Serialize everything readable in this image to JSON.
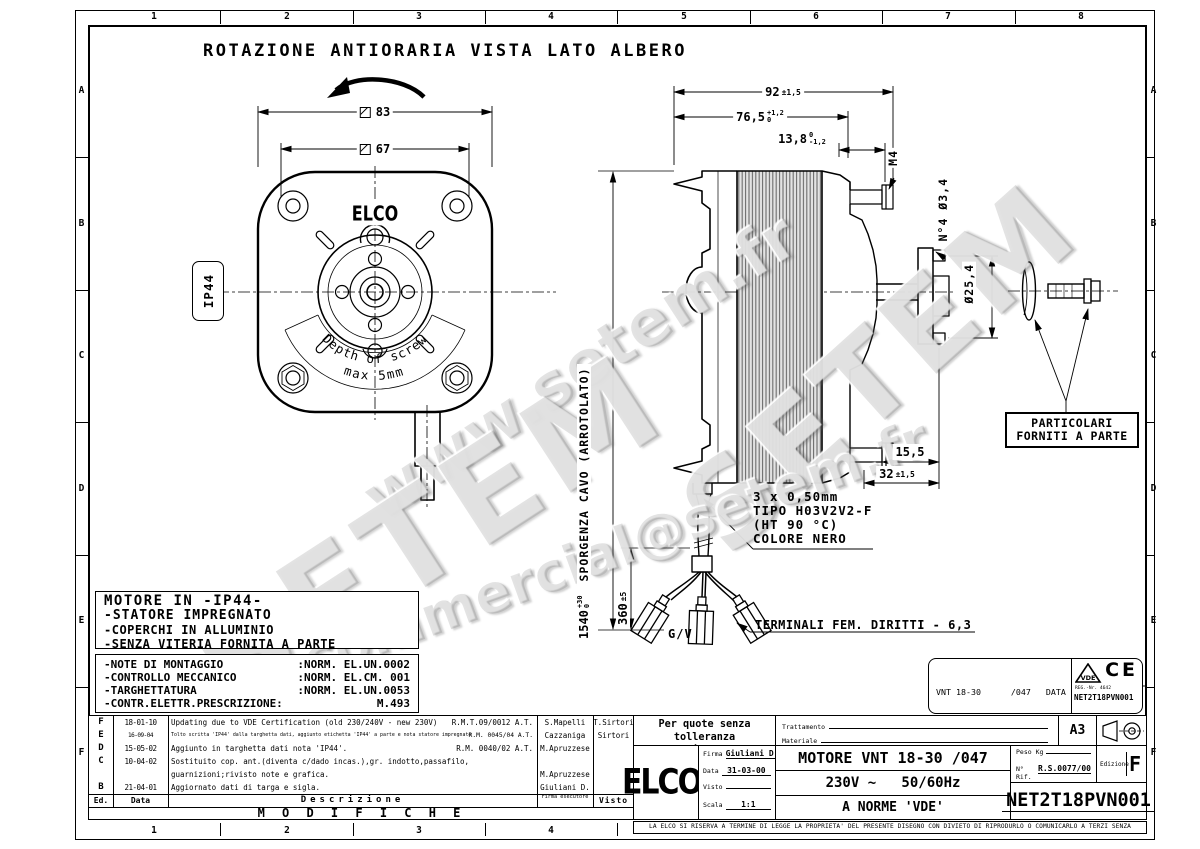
{
  "sheet": {
    "title": "ROTAZIONE ANTIORARIA VISTA LATO ALBERO",
    "columns": [
      "1",
      "2",
      "3",
      "4",
      "5",
      "6",
      "7",
      "8"
    ],
    "columns_bottom": [
      "1",
      "2",
      "3",
      "4"
    ],
    "rows": [
      "A",
      "B",
      "C",
      "D",
      "E",
      "F"
    ],
    "disclaimer": "LA ELCO SI RISERVA A TERMINE DI LEGGE LA PROPRIETA' DEL PRESENTE DISEGNO CON DIVIETO DI RIPRODURLO O COMUNICARLO A TERZI SENZA AUTORIZZAZIONE"
  },
  "watermarks": {
    "url": "www.setem.fr",
    "brand": "SETEM",
    "brand2": "SETEM",
    "email": "commercial@setem.fr"
  },
  "front_view": {
    "dim_outer": "83",
    "dim_inner": "67",
    "ip_rating": "IP44",
    "logo": "ELCO",
    "depth_note_line1": "Depth of screw",
    "depth_note_line2": "max 5mm"
  },
  "side_view": {
    "dim_width": {
      "value": "92",
      "tol": "±1,5"
    },
    "dim_body": {
      "value": "76,5",
      "tol_up": "+1,2",
      "tol_dn": "0"
    },
    "dim_hub": {
      "value": "13,8",
      "tol_up": "0",
      "tol_dn": "-1,2"
    },
    "thread": "M4",
    "holes": "N°4 Ø3,4",
    "flange_dia": "Ø25,4",
    "dim_flange": "15,5",
    "dim_shaft": {
      "value": "32",
      "tol": "±1,5"
    }
  },
  "cable": {
    "length": {
      "value": "1540",
      "tol_up": "+30",
      "tol_dn": "0"
    },
    "length_note": "SPORGENZA CAVO (ARROTOLATO)",
    "free_length": {
      "value": "360",
      "tol": "±5"
    },
    "spec_line1": "3 x 0,50mm",
    "spec_line2": "TIPO H03V2V2-F",
    "spec_line3": "(HT 90 °C)",
    "spec_line4": "COLORE NERO",
    "ground_label": "G/V",
    "terminal_note": "TERMINALI FEM. DIRITTI - 6,3"
  },
  "parts_note": {
    "line1": "PARTICOLARI",
    "line2": "FORNITI A PARTE"
  },
  "motor_notes": {
    "title": "MOTORE IN -IP44-",
    "line1": "-STATORE IMPREGNATO",
    "line2": "-COPERCHI IN ALLUMINIO",
    "line3": "-SENZA VITERIA FORNITA A PARTE"
  },
  "norm_notes": {
    "rows": [
      {
        "label": "-NOTE DI MONTAGGIO",
        "value": ":NORM. EL.UN.0002"
      },
      {
        "label": "-CONTROLLO MECCANICO",
        "value": ":NORM. EL.CM. 001"
      },
      {
        "label": "-TARGHETTATURA",
        "value": ":NORM. EL.UN.0053"
      },
      {
        "label": "-CONTR.ELETTR.PRESCRIZIONE:",
        "value": "M.493"
      }
    ]
  },
  "revisions": {
    "rows": [
      {
        "ed": "F",
        "date": "18-01-10",
        "desc": "Updating due to VDE Certification (old 230/240V - new 230V)",
        "ref": "R.M.T.09/0012 A.T.",
        "firma": "S.Mapelli",
        "visto": "T.Sirtori"
      },
      {
        "ed": "E",
        "date": "16-09-04",
        "desc": "Tolto scritta 'IP44' dalla targhetta dati, aggiunto etichetta 'IP44' a parte e nota statore impregnato",
        "ref": "R.M. 0045/04 A.T.",
        "firma": "Cazzaniga",
        "visto": "Sirtori"
      },
      {
        "ed": "D",
        "date": "15-05-02",
        "desc": "Aggiunto in targhetta dati nota 'IP44'.",
        "ref": "R.M. 0040/02 A.T.",
        "firma": "M.Apruzzese",
        "visto": ""
      },
      {
        "ed": "C",
        "date": "10-04-02",
        "desc": "Sostituito cop. ant.(diventa c/dado incas.),gr. indotto,passafilo,",
        "ref": "",
        "firma": "",
        "visto": ""
      },
      {
        "ed": "",
        "date": "",
        "desc": "guarnizioni;rivisto note e grafica.",
        "ref": "",
        "firma": "M.Apruzzese",
        "visto": ""
      },
      {
        "ed": "B",
        "date": "21-04-01",
        "desc": "Aggiornato dati di targa e sigla.",
        "ref": "",
        "firma": "Giuliani D.",
        "visto": ""
      }
    ],
    "headers": {
      "ed": "Ed.",
      "date": "Data",
      "desc": "Descrizione",
      "firma": "Firma esecutore",
      "visto": "Visto"
    },
    "footer": "M O D I F I C H E"
  },
  "title_block": {
    "tolerance_note1": "Per quote senza tolleranza",
    "tolerance_note2": "normativa UNI EN 22768-mK",
    "trattamento_label": "Trattamento",
    "materiale_label": "Materiale",
    "format": "A3",
    "logo": "ELCO",
    "logo_reg": "®",
    "fields": {
      "firma_label": "Firma",
      "firma": "Giuliani D.",
      "data_label": "Data",
      "data": "31-03-00",
      "visto_label": "Visto",
      "visto": "",
      "scala_label": "Scala",
      "scala": "1:1"
    },
    "product_line1": "MOTORE VNT 18-30 /047",
    "product_line2": "230V ~   50/60Hz",
    "product_line3": "A NORME 'VDE'",
    "peso_label": "Peso Kg",
    "rif_label": "N° Rif.",
    "rif": "R.S.0077/00",
    "edizione_label": "Edizione",
    "edizione": "F",
    "code": "NET2T18PVN001"
  },
  "data_plate": {
    "line1": "VNT 18-30      /047   DATA",
    "line2": "230V ~50/60Hz",
    "line3": "18/73W 0,52A CL.B",
    "line4": "PROT.TERM.  1300/1550RPM",
    "vde": "VDE",
    "ce": "CE",
    "reg": "REG.-Nr. 4642",
    "code": "NET2T18PVN001"
  }
}
